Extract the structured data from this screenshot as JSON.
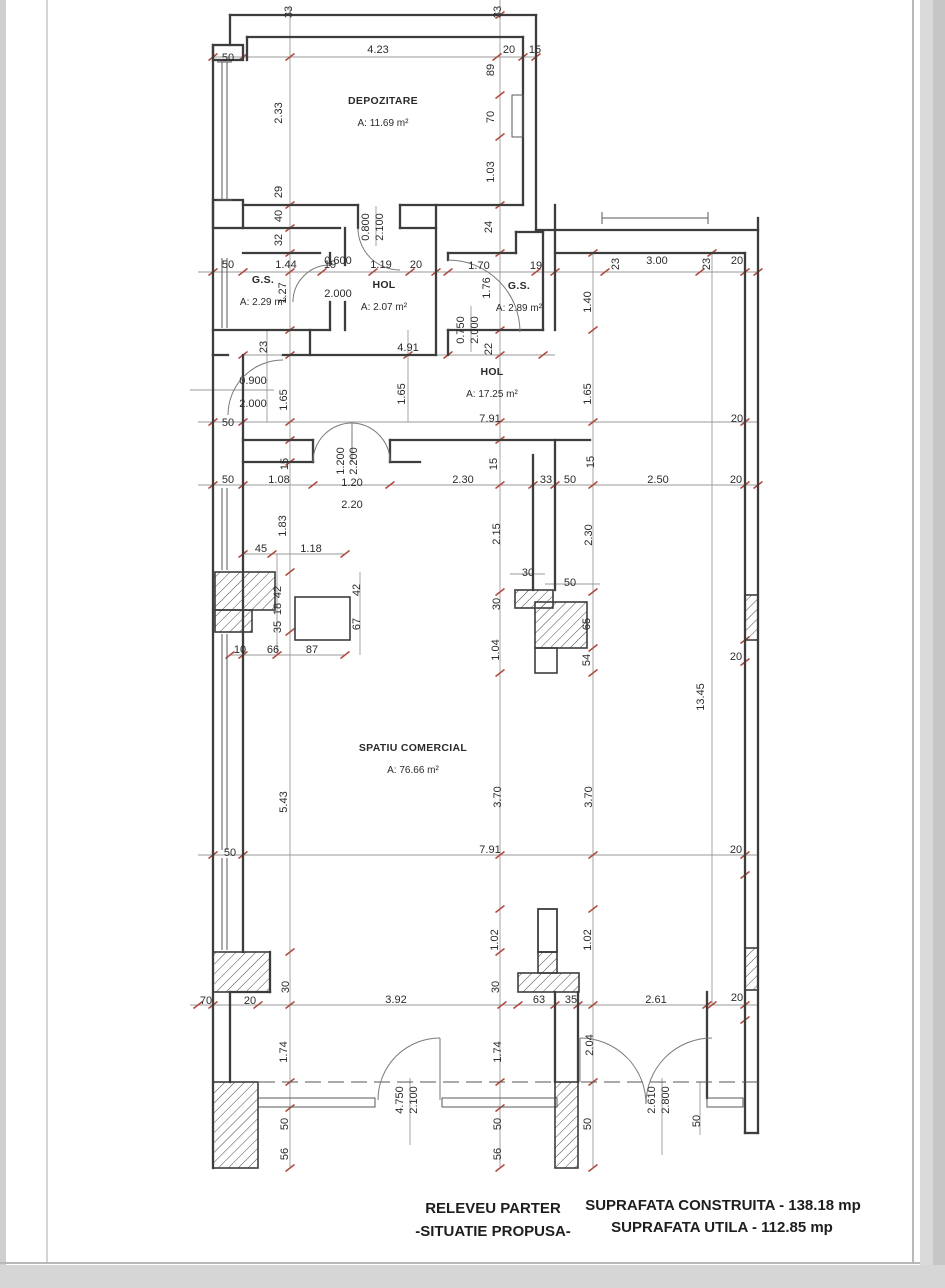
{
  "title_block": {
    "plan_title_line1": "RELEVEU PARTER",
    "plan_title_line2": "-SITUATIE PROPUSA-",
    "area_built": "SUPRAFATA CONSTRUITA  - 138.18 mp",
    "area_usable": "SUPRAFATA UTILA - 112.85 mp"
  },
  "rooms": [
    {
      "name": "DEPOZITARE",
      "area": "A: 11.69 m²",
      "x": 383,
      "y": 104
    },
    {
      "name": "G.S.",
      "area": "A: 2.29 m²",
      "x": 263,
      "y": 283
    },
    {
      "name": "HOL",
      "area": "A: 2.07 m²",
      "x": 384,
      "y": 288
    },
    {
      "name": "G.S.",
      "area": "A: 2.89 m²",
      "x": 519,
      "y": 289
    },
    {
      "name": "HOL",
      "area": "A: 17.25 m²",
      "x": 492,
      "y": 375
    },
    {
      "name": "SPATIU COMERCIAL",
      "area": "A: 76.66 m²",
      "x": 413,
      "y": 751
    }
  ],
  "annotations": {
    "dim_labels": [
      {
        "t": "33",
        "x": 292,
        "y": 12,
        "r": -90
      },
      {
        "t": "33",
        "x": 501,
        "y": 12,
        "r": -90
      },
      {
        "t": "50",
        "x": 228,
        "y": 61,
        "r": 0
      },
      {
        "t": "4.23",
        "x": 378,
        "y": 53,
        "r": 0
      },
      {
        "t": "20",
        "x": 509,
        "y": 53,
        "r": 0
      },
      {
        "t": "15",
        "x": 535,
        "y": 53,
        "r": 0
      },
      {
        "t": "89",
        "x": 494,
        "y": 70,
        "r": -90
      },
      {
        "t": "2.33",
        "x": 282,
        "y": 113,
        "r": -90
      },
      {
        "t": "70",
        "x": 494,
        "y": 117,
        "r": -90
      },
      {
        "t": "1.03",
        "x": 494,
        "y": 172,
        "r": -90
      },
      {
        "t": "29",
        "x": 282,
        "y": 192,
        "r": -90
      },
      {
        "t": "40",
        "x": 282,
        "y": 216,
        "r": -90
      },
      {
        "t": "32",
        "x": 282,
        "y": 240,
        "r": -90
      },
      {
        "t": "24",
        "x": 492,
        "y": 227,
        "r": -90
      },
      {
        "t": "0.800",
        "x": 369,
        "y": 227,
        "r": -90
      },
      {
        "t": "2.100",
        "x": 383,
        "y": 227,
        "r": -90
      },
      {
        "t": "50",
        "x": 228,
        "y": 268,
        "r": 0
      },
      {
        "t": "1.44",
        "x": 286,
        "y": 268,
        "r": 0
      },
      {
        "t": "19",
        "x": 330,
        "y": 268,
        "r": 0
      },
      {
        "t": "1.19",
        "x": 381,
        "y": 268,
        "r": 0
      },
      {
        "t": "20",
        "x": 416,
        "y": 268,
        "r": 0
      },
      {
        "t": "1.70",
        "x": 479,
        "y": 269,
        "r": 0
      },
      {
        "t": "19",
        "x": 536,
        "y": 269,
        "r": 0
      },
      {
        "t": "23",
        "x": 619,
        "y": 264,
        "r": -90
      },
      {
        "t": "3.00",
        "x": 657,
        "y": 264,
        "r": 0
      },
      {
        "t": "23",
        "x": 710,
        "y": 264,
        "r": -90
      },
      {
        "t": "20",
        "x": 737,
        "y": 264,
        "r": 0
      },
      {
        "t": "1.27",
        "x": 286,
        "y": 293,
        "r": -90
      },
      {
        "t": "1.76",
        "x": 490,
        "y": 288,
        "r": -90
      },
      {
        "t": "0.600",
        "x": 338,
        "y": 264,
        "r": 0
      },
      {
        "t": "2.000",
        "x": 338,
        "y": 297,
        "r": 0
      },
      {
        "t": "0.750",
        "x": 464,
        "y": 330,
        "r": -90
      },
      {
        "t": "2.000",
        "x": 478,
        "y": 330,
        "r": -90
      },
      {
        "t": "1.40",
        "x": 591,
        "y": 302,
        "r": -90
      },
      {
        "t": "23",
        "x": 267,
        "y": 347,
        "r": -90
      },
      {
        "t": "4.91",
        "x": 408,
        "y": 351,
        "r": 0
      },
      {
        "t": "22",
        "x": 492,
        "y": 349,
        "r": -90
      },
      {
        "t": "0.900",
        "x": 253,
        "y": 384,
        "r": 0
      },
      {
        "t": "2.000",
        "x": 253,
        "y": 407,
        "r": 0
      },
      {
        "t": "1.65",
        "x": 287,
        "y": 400,
        "r": -90
      },
      {
        "t": "1.65",
        "x": 405,
        "y": 394,
        "r": -90
      },
      {
        "t": "1.65",
        "x": 591,
        "y": 394,
        "r": -90
      },
      {
        "t": "50",
        "x": 228,
        "y": 426,
        "r": 0
      },
      {
        "t": "7.91",
        "x": 490,
        "y": 422,
        "r": 0
      },
      {
        "t": "20",
        "x": 737,
        "y": 422,
        "r": 0
      },
      {
        "t": "15",
        "x": 288,
        "y": 464,
        "r": -90
      },
      {
        "t": "1.200",
        "x": 344,
        "y": 461,
        "r": -90
      },
      {
        "t": "2.200",
        "x": 357,
        "y": 461,
        "r": -90
      },
      {
        "t": "15",
        "x": 497,
        "y": 464,
        "r": -90
      },
      {
        "t": "15",
        "x": 594,
        "y": 462,
        "r": -90
      },
      {
        "t": "50",
        "x": 228,
        "y": 483,
        "r": 0
      },
      {
        "t": "1.08",
        "x": 279,
        "y": 483,
        "r": 0
      },
      {
        "t": "1.20",
        "x": 352,
        "y": 486,
        "r": 0
      },
      {
        "t": "2.20",
        "x": 352,
        "y": 508,
        "r": 0
      },
      {
        "t": "2.30",
        "x": 463,
        "y": 483,
        "r": 0
      },
      {
        "t": "33",
        "x": 546,
        "y": 483,
        "r": 0
      },
      {
        "t": "50",
        "x": 570,
        "y": 483,
        "r": 0
      },
      {
        "t": "2.50",
        "x": 658,
        "y": 483,
        "r": 0
      },
      {
        "t": "20",
        "x": 736,
        "y": 483,
        "r": 0
      },
      {
        "t": "1.83",
        "x": 286,
        "y": 526,
        "r": -90
      },
      {
        "t": "2.15",
        "x": 500,
        "y": 534,
        "r": -90
      },
      {
        "t": "2.30",
        "x": 592,
        "y": 535,
        "r": -90
      },
      {
        "t": "45",
        "x": 261,
        "y": 552,
        "r": 0
      },
      {
        "t": "1.18",
        "x": 311,
        "y": 552,
        "r": 0
      },
      {
        "t": "42",
        "x": 281,
        "y": 592,
        "r": -90
      },
      {
        "t": "18",
        "x": 281,
        "y": 609,
        "r": -90
      },
      {
        "t": "35",
        "x": 281,
        "y": 627,
        "r": -90
      },
      {
        "t": "42",
        "x": 360,
        "y": 590,
        "r": -90
      },
      {
        "t": "67",
        "x": 360,
        "y": 624,
        "r": -90
      },
      {
        "t": "30",
        "x": 528,
        "y": 576,
        "r": 0
      },
      {
        "t": "50",
        "x": 570,
        "y": 586,
        "r": 0
      },
      {
        "t": "30",
        "x": 500,
        "y": 604,
        "r": -90
      },
      {
        "t": "65",
        "x": 590,
        "y": 624,
        "r": -90
      },
      {
        "t": "54",
        "x": 590,
        "y": 660,
        "r": -90
      },
      {
        "t": "1.04",
        "x": 499,
        "y": 650,
        "r": -90
      },
      {
        "t": "10",
        "x": 240,
        "y": 653,
        "r": 0
      },
      {
        "t": "66",
        "x": 273,
        "y": 653,
        "r": 0
      },
      {
        "t": "87",
        "x": 312,
        "y": 653,
        "r": 0
      },
      {
        "t": "20",
        "x": 736,
        "y": 660,
        "r": 0
      },
      {
        "t": "13.45",
        "x": 704,
        "y": 697,
        "r": -90
      },
      {
        "t": "5.43",
        "x": 287,
        "y": 802,
        "r": -90
      },
      {
        "t": "3.70",
        "x": 501,
        "y": 797,
        "r": -90
      },
      {
        "t": "3.70",
        "x": 592,
        "y": 797,
        "r": -90
      },
      {
        "t": "50",
        "x": 230,
        "y": 856,
        "r": 0
      },
      {
        "t": "7.91",
        "x": 490,
        "y": 853,
        "r": 0
      },
      {
        "t": "20",
        "x": 736,
        "y": 853,
        "r": 0
      },
      {
        "t": "1.02",
        "x": 498,
        "y": 940,
        "r": -90
      },
      {
        "t": "1.02",
        "x": 591,
        "y": 940,
        "r": -90
      },
      {
        "t": "30",
        "x": 289,
        "y": 987,
        "r": -90
      },
      {
        "t": "30",
        "x": 499,
        "y": 987,
        "r": -90
      },
      {
        "t": "70",
        "x": 206,
        "y": 1004,
        "r": 0
      },
      {
        "t": "20",
        "x": 250,
        "y": 1004,
        "r": 0
      },
      {
        "t": "3.92",
        "x": 396,
        "y": 1003,
        "r": 0
      },
      {
        "t": "63",
        "x": 539,
        "y": 1003,
        "r": 0
      },
      {
        "t": "35",
        "x": 571,
        "y": 1003,
        "r": 0
      },
      {
        "t": "2.61",
        "x": 656,
        "y": 1003,
        "r": 0
      },
      {
        "t": "20",
        "x": 737,
        "y": 1001,
        "r": 0
      },
      {
        "t": "1.74",
        "x": 287,
        "y": 1052,
        "r": -90
      },
      {
        "t": "1.74",
        "x": 501,
        "y": 1052,
        "r": -90
      },
      {
        "t": "2.04",
        "x": 593,
        "y": 1045,
        "r": -90
      },
      {
        "t": "4.750",
        "x": 403,
        "y": 1100,
        "r": -90
      },
      {
        "t": "2.100",
        "x": 417,
        "y": 1100,
        "r": -90
      },
      {
        "t": "2.610",
        "x": 655,
        "y": 1100,
        "r": -90
      },
      {
        "t": "2.800",
        "x": 669,
        "y": 1100,
        "r": -90
      },
      {
        "t": "50",
        "x": 288,
        "y": 1124,
        "r": -90
      },
      {
        "t": "56",
        "x": 288,
        "y": 1154,
        "r": -90
      },
      {
        "t": "50",
        "x": 501,
        "y": 1124,
        "r": -90
      },
      {
        "t": "56",
        "x": 501,
        "y": 1154,
        "r": -90
      },
      {
        "t": "50",
        "x": 591,
        "y": 1124,
        "r": -90
      },
      {
        "t": "50",
        "x": 700,
        "y": 1121,
        "r": -90
      }
    ]
  }
}
